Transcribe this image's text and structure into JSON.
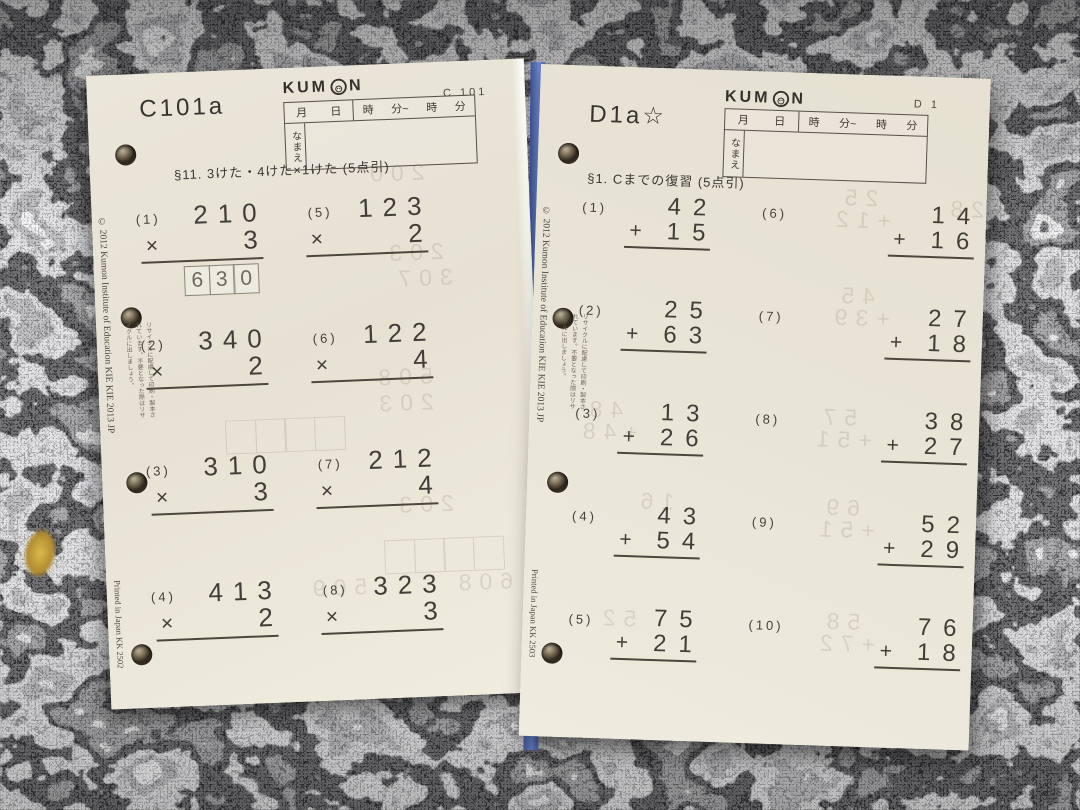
{
  "scene": {
    "surface": "granite-countertop",
    "colors": {
      "granite_base": "#6f6f72",
      "paper": "#e9e5d8",
      "ink": "#403e38",
      "ghost_ink": "#6e6450",
      "divider_blue": "#5b77c4",
      "gold_fleck": "#c9a93c"
    }
  },
  "left_sheet": {
    "title": "C101a",
    "corner_code": "C 101",
    "brand": {
      "full": "KUMON",
      "pre": "KUM",
      "post": "N"
    },
    "header_table": {
      "date_cells": [
        "月",
        "日"
      ],
      "time_cells": [
        "時",
        "分~",
        "時",
        "分"
      ],
      "name_label": "なまえ"
    },
    "section": "§11. 3けた・4けた×1けた (5点引)",
    "problems": [
      {
        "num": "(1)",
        "top": "210",
        "op": "×",
        "bottom": "3",
        "answer": "630"
      },
      {
        "num": "(2)",
        "top": "340",
        "op": "×",
        "bottom": "2"
      },
      {
        "num": "(3)",
        "top": "310",
        "op": "×",
        "bottom": "3"
      },
      {
        "num": "(4)",
        "top": "413",
        "op": "×",
        "bottom": "2"
      },
      {
        "num": "(5)",
        "top": "123",
        "op": "×",
        "bottom": "2"
      },
      {
        "num": "(6)",
        "top": "122",
        "op": "×",
        "bottom": "4"
      },
      {
        "num": "(7)",
        "top": "212",
        "op": "×",
        "bottom": "4"
      },
      {
        "num": "(8)",
        "top": "323",
        "op": "×",
        "bottom": "3"
      }
    ],
    "ghost_numbers": [
      {
        "text": "200",
        "x": 272,
        "y": 96
      },
      {
        "text": "203",
        "x": 288,
        "y": 176
      },
      {
        "text": "307",
        "x": 296,
        "y": 202
      },
      {
        "text": "508",
        "x": 272,
        "y": 300
      },
      {
        "text": "203",
        "x": 272,
        "y": 326
      },
      {
        "text": "203",
        "x": 288,
        "y": 428
      },
      {
        "text": "509",
        "x": 198,
        "y": 508
      },
      {
        "text": "608",
        "x": 344,
        "y": 508
      }
    ],
    "ghost_box_strips": [
      {
        "x": 126,
        "y": 350,
        "boxes": 4
      },
      {
        "x": 280,
        "y": 476,
        "boxes": 4
      }
    ],
    "edge_copyright": "© 2012 Kumon Institute of Education  KIE KIE 2013 JP",
    "edge_printed": "Printed in Japan  KK  2502",
    "recycle_note": "リサイクルに配慮して印刷・製本されています。不要となった際はリサイクルに出しましょう。"
  },
  "right_sheet": {
    "title": "D1a☆",
    "corner_code": "D 1",
    "brand": {
      "full": "KUMON",
      "pre": "KUM",
      "post": "N"
    },
    "header_table": {
      "date_cells": [
        "月",
        "日"
      ],
      "time_cells": [
        "時",
        "分~",
        "時",
        "分"
      ],
      "name_label": "なまえ"
    },
    "section": "§1. Cまでの復習 (5点引)",
    "problems": [
      {
        "num": "(1)",
        "top": "42",
        "op": "+",
        "bottom": "15"
      },
      {
        "num": "(2)",
        "top": "25",
        "op": "+",
        "bottom": "63"
      },
      {
        "num": "(3)",
        "top": "13",
        "op": "+",
        "bottom": "26"
      },
      {
        "num": "(4)",
        "top": "43",
        "op": "+",
        "bottom": "54"
      },
      {
        "num": "(5)",
        "top": "75",
        "op": "+",
        "bottom": "21"
      },
      {
        "num": "(6)",
        "top": "14",
        "op": "+",
        "bottom": "16"
      },
      {
        "num": "(7)",
        "top": "27",
        "op": "+",
        "bottom": "18"
      },
      {
        "num": "(8)",
        "top": "38",
        "op": "+",
        "bottom": "27"
      },
      {
        "num": "(9)",
        "top": "52",
        "op": "+",
        "bottom": "29"
      },
      {
        "num": "(10)",
        "top": "76",
        "op": "+",
        "bottom": "18"
      }
    ],
    "ghost_numbers": [
      {
        "text": "25",
        "x": 300,
        "y": 110
      },
      {
        "text": "+12",
        "x": 292,
        "y": 132
      },
      {
        "text": "+28",
        "x": 406,
        "y": 118
      },
      {
        "text": "45",
        "x": 300,
        "y": 208
      },
      {
        "text": "+39",
        "x": 294,
        "y": 230
      },
      {
        "text": "48",
        "x": 52,
        "y": 330
      },
      {
        "text": "+48",
        "x": 46,
        "y": 352
      },
      {
        "text": "57",
        "x": 286,
        "y": 330
      },
      {
        "text": "+51",
        "x": 280,
        "y": 352
      },
      {
        "text": "16",
        "x": 106,
        "y": 420
      },
      {
        "text": "69",
        "x": 292,
        "y": 420
      },
      {
        "text": "+51",
        "x": 286,
        "y": 442
      },
      {
        "text": "52",
        "x": 72,
        "y": 538
      },
      {
        "text": "58",
        "x": 296,
        "y": 534
      },
      {
        "text": "+72",
        "x": 290,
        "y": 556
      }
    ],
    "ghost_box_strips": [],
    "edge_copyright": "© 2012 Kumon Institute of Education  KIE KIE 2013 JP",
    "edge_printed": "Printed in Japan  KK  2503",
    "recycle_note": "リサイクルに配慮して印刷・製本されています。不要となった際はリサイクルに出しましょう。"
  }
}
